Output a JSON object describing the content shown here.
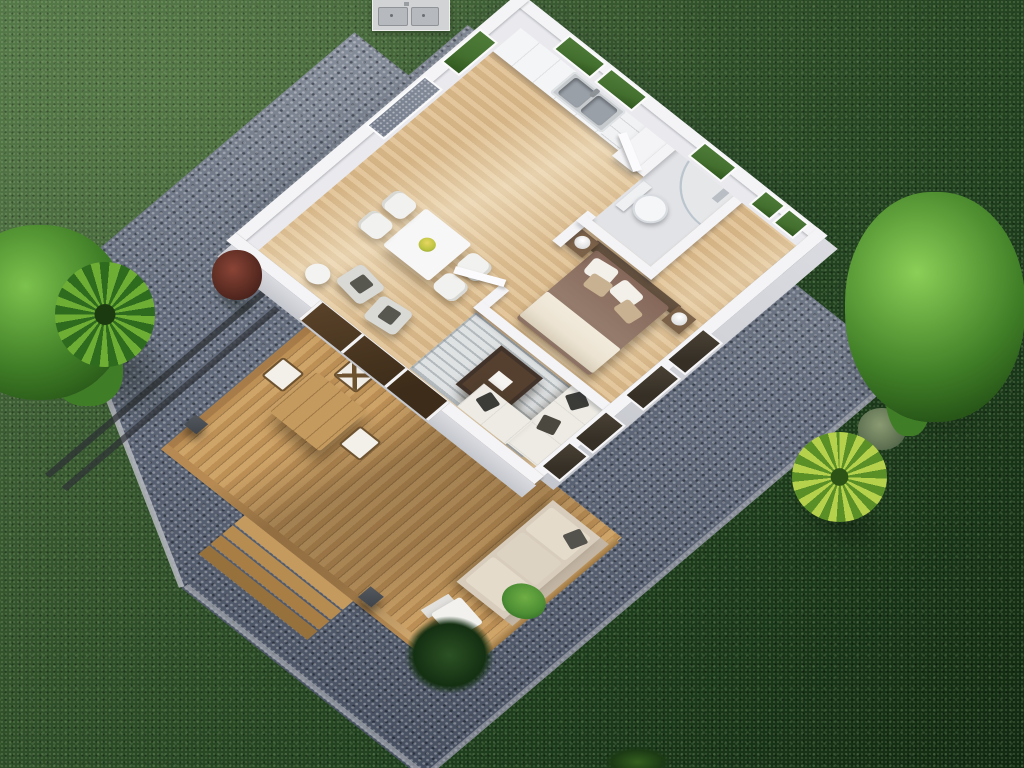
{
  "scene": {
    "type": "3d-aerial-floor-plan-render",
    "description": "Top-down 3D rendering of a one-bedroom tiny house with wooden deck, gravel border and lawn",
    "rooms": [
      "kitchen-dining",
      "living-room",
      "bedroom",
      "bathroom",
      "deck"
    ],
    "objects": {
      "kitchen": [
        "counter-cabinets",
        "double-stainless-sink",
        "drawer-stack",
        "tall-cabinet",
        "windows"
      ],
      "dining": [
        "white-square-table",
        "four-white-chairs",
        "table-plant"
      ],
      "living": [
        "striped-rug",
        "dark-coffee-table",
        "white-corner-sofa",
        "dark-throw-pillows",
        "two-gray-armchairs",
        "side-table",
        "sliding-glass-doors"
      ],
      "bedroom": [
        "double-bed",
        "brown-headboard",
        "brown-duvet",
        "cream-folded-blanket",
        "pillows",
        "two-nightstands",
        "two-lamps",
        "windows"
      ],
      "bathroom": [
        "toilet",
        "curved-glass-shower",
        "window",
        "open-door"
      ],
      "deck": [
        "plank-decking",
        "outdoor-wood-table",
        "three-outdoor-chairs",
        "outdoor-beige-sofa",
        "white-lounge-chair",
        "potted-plant",
        "wood-steps",
        "railing",
        "dark-posts"
      ],
      "yard": [
        "lawn",
        "gravel-border",
        "metal-edge-rails",
        "left-green-tree",
        "left-palm",
        "red-shrub",
        "right-green-tree",
        "yellow-palm",
        "sage-bush",
        "grass-tuft"
      ],
      "overlay": [
        "sink-detail-inset"
      ]
    }
  },
  "palette": {
    "grass1": "#4d6f44",
    "grass2": "#35552e",
    "grass3": "#1f3f1e",
    "grass4": "#122a12",
    "gravel1": "#8e95a1",
    "gravel2": "#636c7c",
    "gravel3": "#454e5f",
    "gravelEdge": "#b7bac0",
    "deck1": "#cfa468",
    "deck2": "#bd9056",
    "fascia": "#b68a52",
    "fasciaDark": "#a87c48",
    "floor1": "#e3c69b",
    "floor2": "#d4b384",
    "wallTop": "#f4f4f6",
    "wallInner": "#e9e9ee",
    "wallFace": "#dadbe0",
    "wallFaceDark": "#c4c7cd",
    "windowGreen": "#44702f",
    "windowGravel": "#767e8d",
    "glassDark": "#352f26",
    "glassBrown": "#3c2c19",
    "rug": "#dfe2e3",
    "rugStripe": "#b3babd",
    "sofaWhite": "#edebe4",
    "cushionDark": "#3b3b38",
    "outdoorSofa": "#d8cdbd",
    "outdoorSofaTrim": "#c2b5a3",
    "bedHead": "#64513f",
    "bedDuvet": "#947b6b",
    "bedBlanket": "#ece3d2",
    "pillowWhite": "#f3f0e9",
    "pillowTan": "#c8b190",
    "nightstand": "#7b6148",
    "coffeeTable": "#42332a",
    "coffeeTableTop": "#55402f",
    "tableWhite": "#f7f7f7",
    "chairWhite": "#f1f1ef",
    "armchairGray": "#d9d9d6",
    "outTable": "#c59a5e",
    "outChairFrame": "#6e5330",
    "post": "#3f444b",
    "railDark": "#2d3136",
    "stainless": "#c6cacd",
    "basin": "#9aa0a7",
    "treeL1": "#7cc24d",
    "treeL2": "#3f7d26",
    "treeL3": "#234f15",
    "palm1": "#6fae35",
    "palm2": "#2f6b1f",
    "palmY1": "#b6d14b",
    "palmY2": "#5a8f28",
    "bushRed1": "#8a4436",
    "bushRed2": "#47211a",
    "sage1": "#8a9b72",
    "sage2": "#4f6246",
    "tuft1": "#2c5124",
    "tuft2": "#143012",
    "potDark": "#2b2e31",
    "plantGreen": "#4e8f35",
    "insetBg": "#d2d3d5",
    "insetBasin": "#b6b9bd"
  }
}
